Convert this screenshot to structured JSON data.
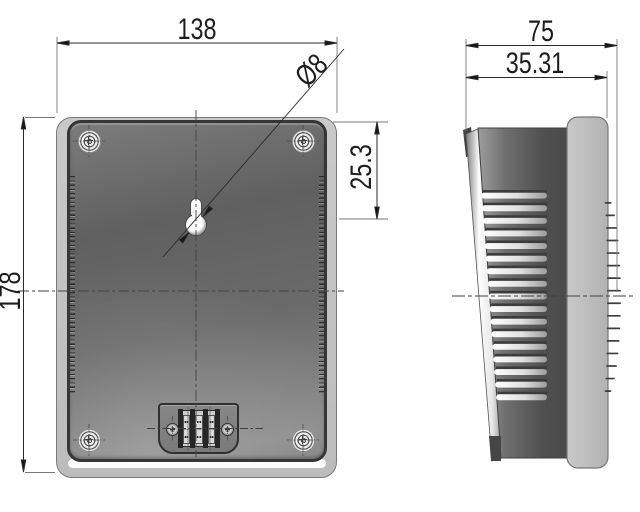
{
  "drawing": {
    "title": "wall-mount speaker dimensional drawing, back and side views",
    "views": {
      "back": "back view",
      "side": "side view"
    },
    "dimensions": {
      "back_width": "138",
      "back_height": "178",
      "keyhole_diameter": "Ø8",
      "keyhole_offset": "25.3",
      "side_depth_total": "75",
      "side_depth_body": "35.31"
    },
    "colors": {
      "line": "#2a2a2a",
      "extension_line": "#777777",
      "panel_dark": "#6b6b6b",
      "flange_light": "#c4c4c4",
      "background": "#ffffff"
    },
    "geometry": {
      "corner_screws": 4,
      "terminal_poles": 4,
      "vent_slots": {
        "count": 17,
        "top": 190,
        "pitch": 12.6,
        "left_start": 481,
        "left_slope": 0.95,
        "right_end": 547
      },
      "hatch_dashes": {
        "count": 16,
        "top": 202,
        "pitch": 12.55,
        "edge_x": 606.5,
        "bulge": 14.5,
        "center_y": 296,
        "semi_axis": 100
      }
    }
  }
}
